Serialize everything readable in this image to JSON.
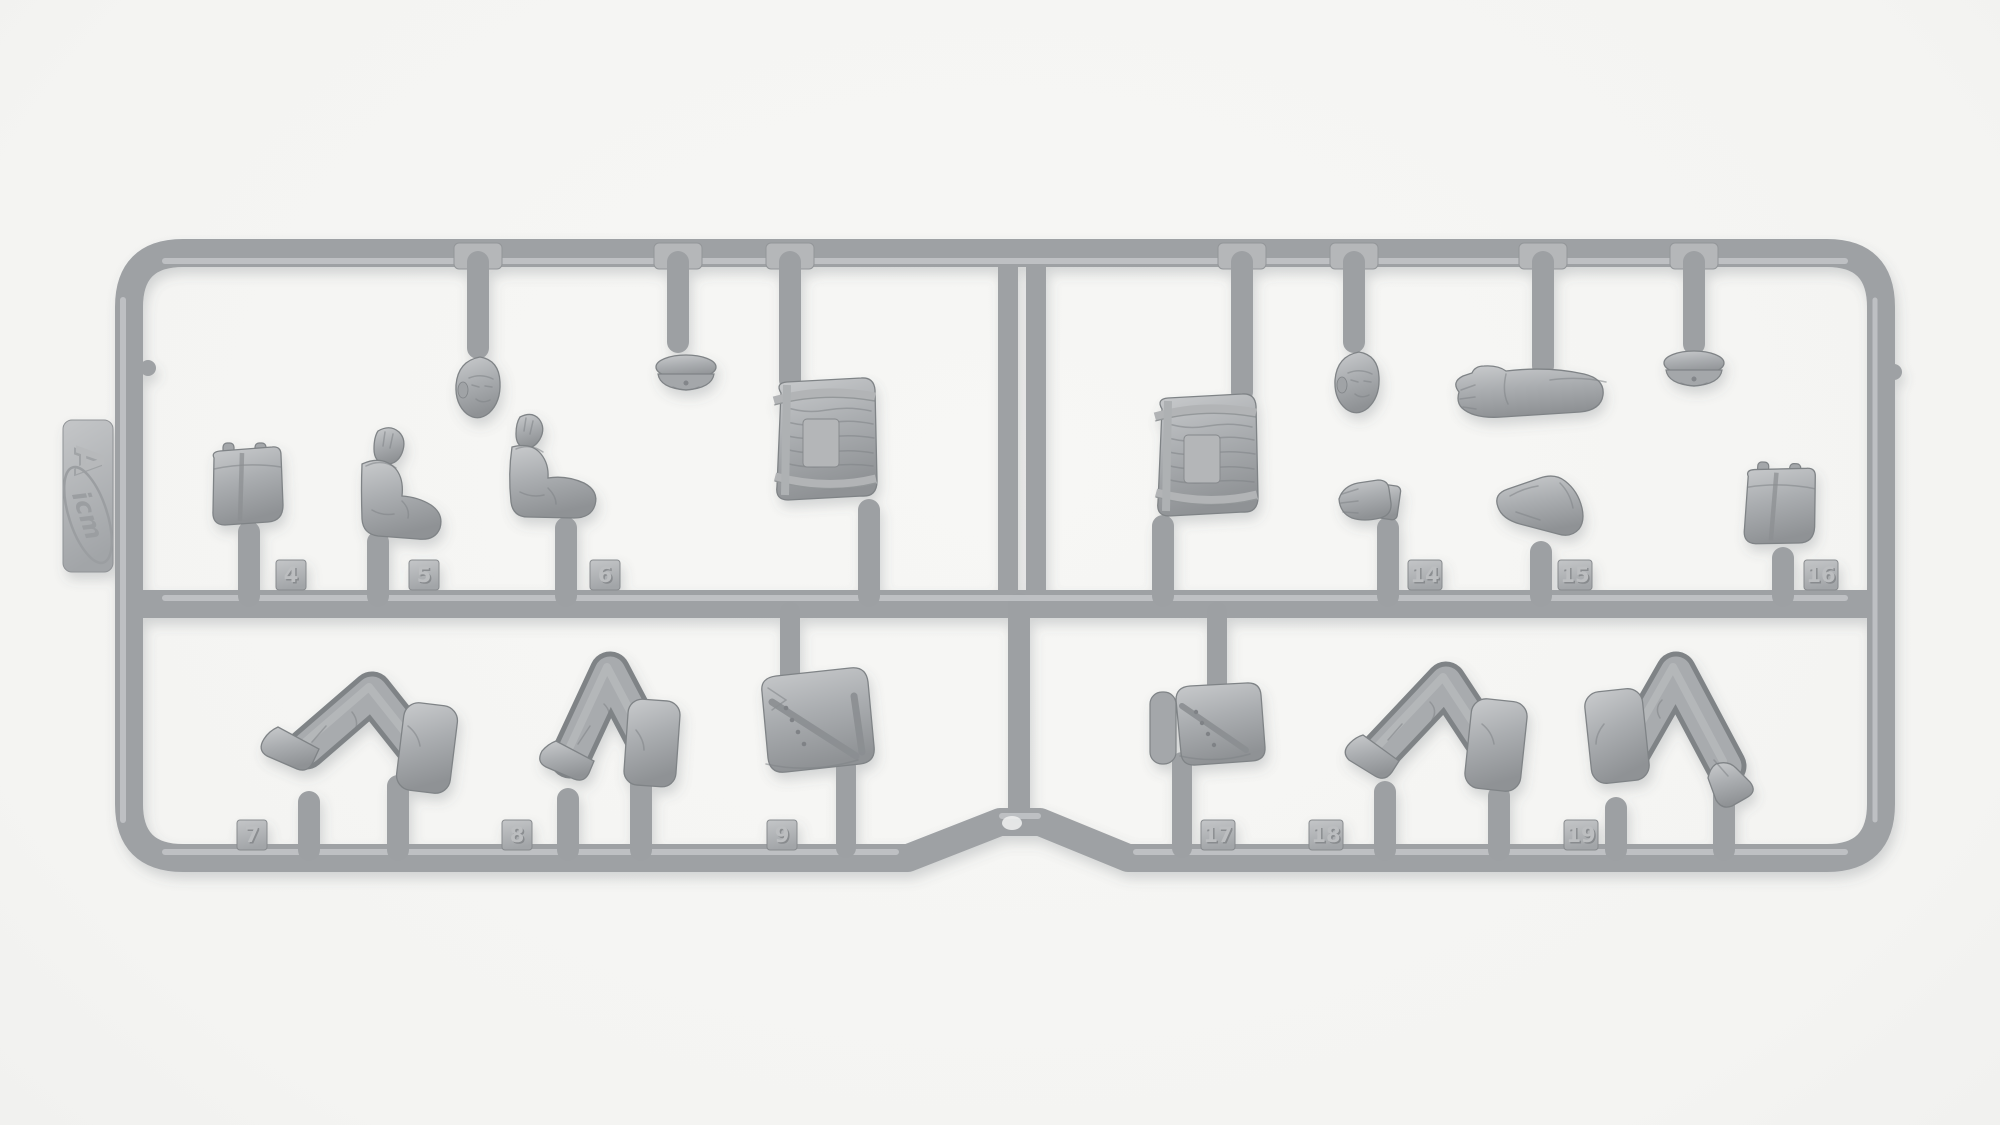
{
  "scene": {
    "description": "Gray injection-molded plastic model sprue (runner) with 1:35 figure parts photographed on a white background",
    "brand": "ICM",
    "sprue_letter": "A"
  },
  "colors": {
    "plastic": "#a4a7aa",
    "plastic_highlight": "#c6c8ca",
    "plastic_shadow": "#7f8386",
    "background_center": "#f6f6f4",
    "background_edge": "#d4d4d2"
  },
  "tab": {
    "brand": "icm",
    "letter": "A"
  },
  "tags": {
    "t4": "4",
    "t5": "5",
    "t6": "6",
    "t7": "7",
    "t8": "8",
    "t9": "9",
    "t14": "14",
    "t15": "15",
    "t16": "16",
    "t17": "17",
    "t18": "18",
    "t19": "19"
  },
  "parts": [
    {
      "tag": "4",
      "name": "canvas pouch"
    },
    {
      "tag": "5",
      "name": "bent arm with raised open hand"
    },
    {
      "tag": "6",
      "name": "bent arm with raised open hand"
    },
    {
      "tag": "7",
      "name": "bent legs with boot"
    },
    {
      "tag": "8",
      "name": "bent legs with boot"
    },
    {
      "tag": "9",
      "name": "jacket torso with cross-belt"
    },
    {
      "tag": "14",
      "name": "open hand with cuff"
    },
    {
      "tag": "15",
      "name": "resting bent arm"
    },
    {
      "tag": "16",
      "name": "canvas pouch"
    },
    {
      "tag": "17",
      "name": "jacket torso with cross-belt and roll"
    },
    {
      "tag": "18",
      "name": "bent legs with boot"
    },
    {
      "tag": "19",
      "name": "bent legs with boot"
    },
    {
      "tag": null,
      "name": "bearded head"
    },
    {
      "tag": null,
      "name": "mustached head"
    },
    {
      "tag": null,
      "name": "peaked cap"
    },
    {
      "tag": null,
      "name": "peaked cap"
    },
    {
      "tag": null,
      "name": "wicker basket backpack"
    },
    {
      "tag": null,
      "name": "wicker basket backpack"
    },
    {
      "tag": null,
      "name": "extended straight arm"
    }
  ]
}
